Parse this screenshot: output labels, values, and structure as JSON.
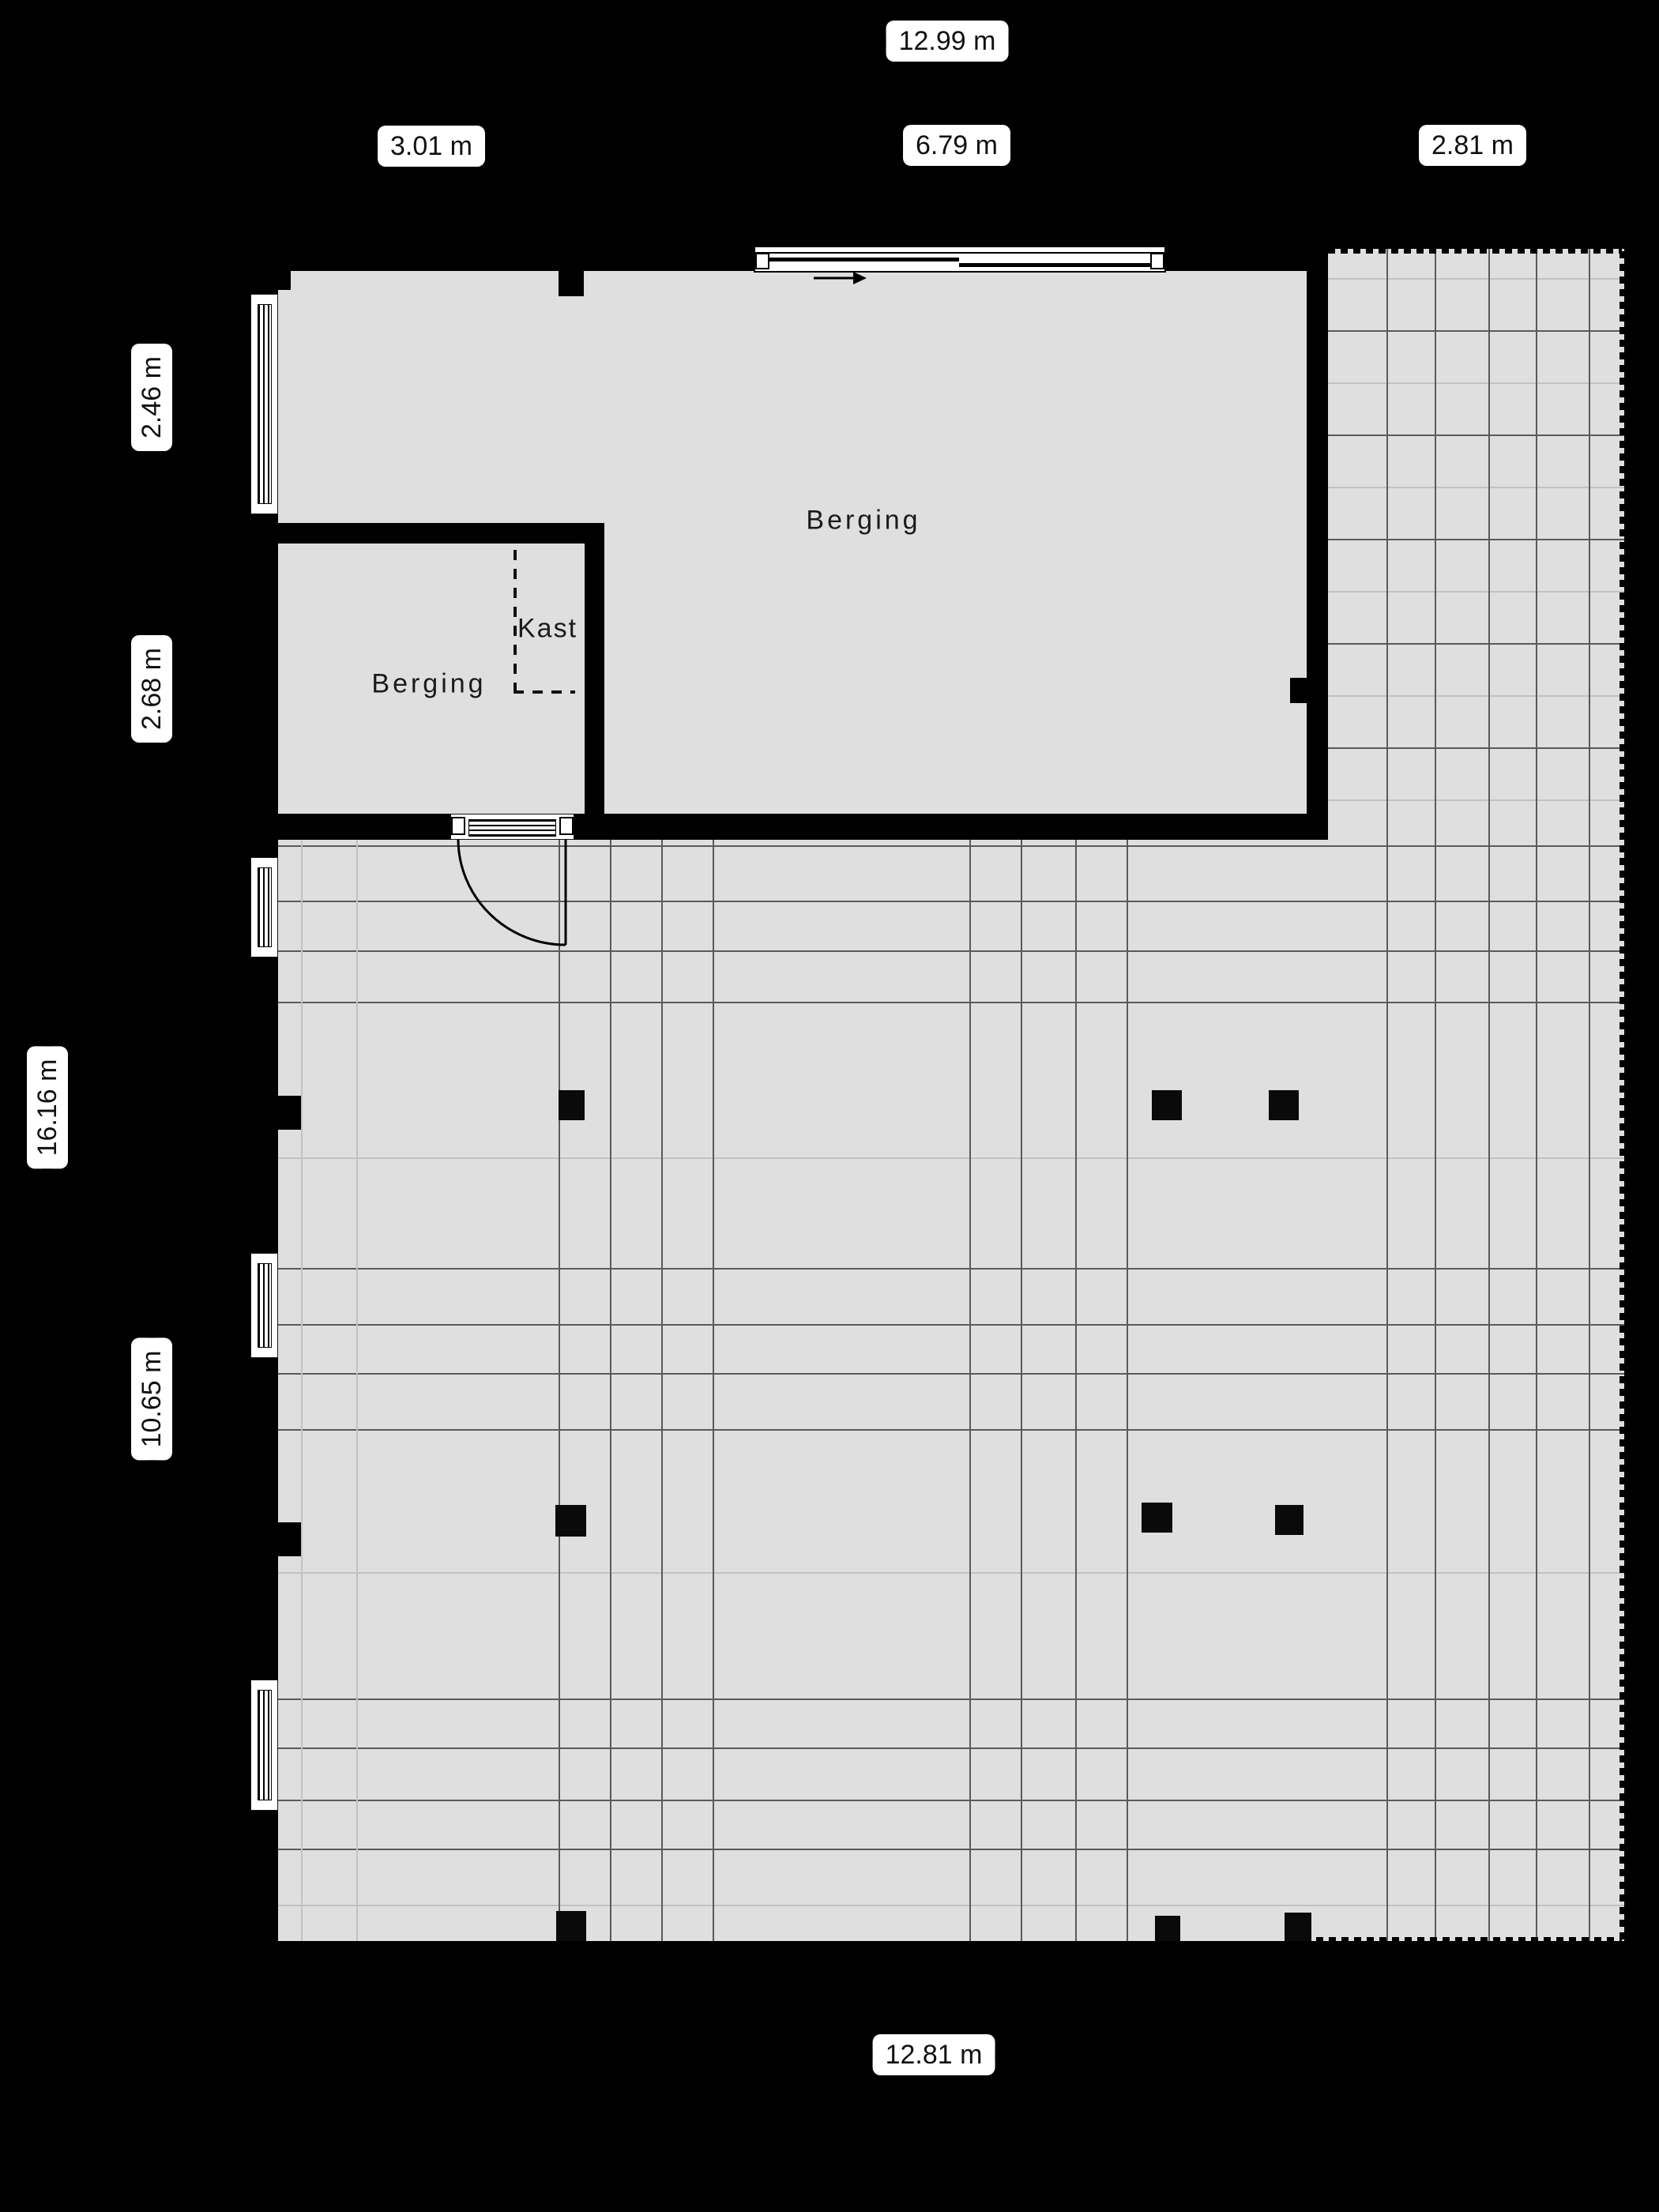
{
  "floor_plan": {
    "rooms": {
      "berging_large": "Berging",
      "berging_small": "Berging",
      "kast": "Kast"
    },
    "dimensions": {
      "top_total": "12.99 m",
      "top_left": "3.01 m",
      "top_middle": "6.79 m",
      "top_right": "2.81 m",
      "side_upper": "2.46 m",
      "side_middle": "2.68 m",
      "side_total": "16.16 m",
      "side_lower": "10.65 m",
      "bottom_total": "12.81 m"
    },
    "colors": {
      "background": "#000000",
      "floor": "#dfdfdf",
      "wall": "#000000",
      "label_background": "#ffffff",
      "label_text": "#111111",
      "grid_line_dark": "#5a5a5a",
      "grid_line_light": "#c2c2c2"
    }
  }
}
